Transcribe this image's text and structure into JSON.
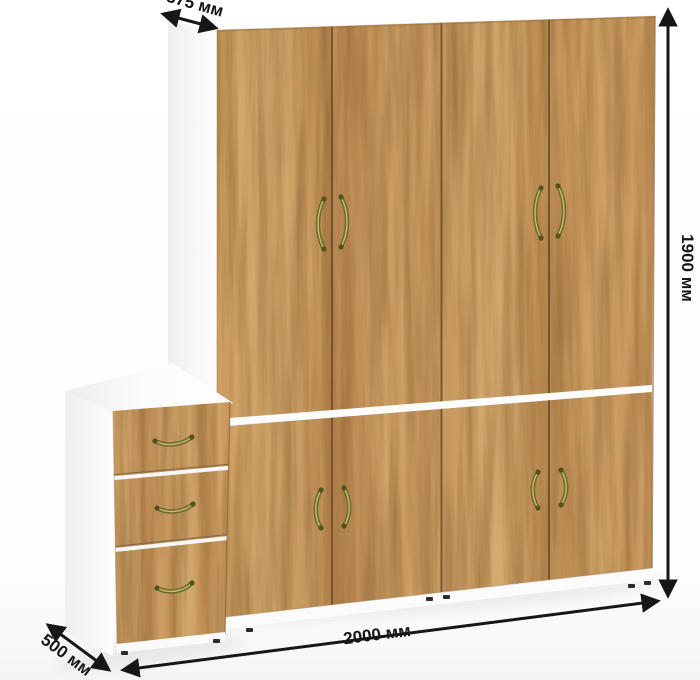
{
  "diagram": {
    "kind": "furniture-dimension-diagram",
    "product": "wardrobe-with-drawer-cabinet",
    "sections": {
      "upper_doors": 4,
      "lower_doors": 4,
      "drawers": 3
    },
    "colors": {
      "wood": "#c79a5f",
      "wood_dark_streak": "#6e4a1f",
      "carcass_white": "#ffffff",
      "handle_brass": "#6e6a30",
      "dimension_lines": "#161616",
      "background": "#ffffff"
    }
  },
  "dimensions": {
    "top_depth": "375 мм",
    "height": "1900 мм",
    "width": "2000 мм",
    "drawer_depth": "500 мм"
  }
}
